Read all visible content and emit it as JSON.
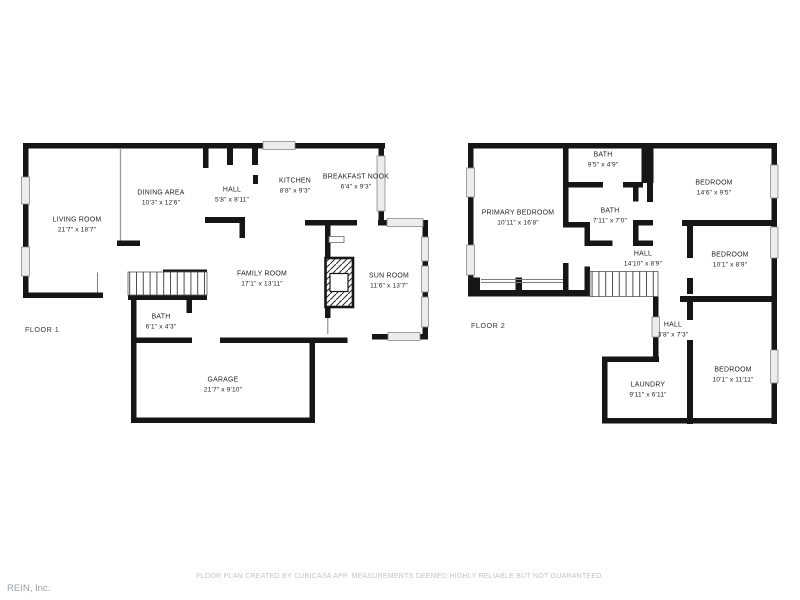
{
  "floors": [
    {
      "label": "FLOOR 1",
      "rooms": [
        {
          "name": "LIVING ROOM",
          "dims": "21'7\" x 18'7\"",
          "x": 77,
          "y": 225
        },
        {
          "name": "DINING AREA",
          "dims": "10'3\" x 12'6\"",
          "x": 161,
          "y": 198
        },
        {
          "name": "HALL",
          "dims": "5'8\" x 8'11\"",
          "x": 232,
          "y": 195
        },
        {
          "name": "KITCHEN",
          "dims": "8'8\" x 9'3\"",
          "x": 295,
          "y": 186
        },
        {
          "name": "BREAKFAST NOOK",
          "dims": "6'4\" x 9'3\"",
          "x": 356,
          "y": 182
        },
        {
          "name": "FAMILY ROOM",
          "dims": "17'1\" x 13'11\"",
          "x": 262,
          "y": 279
        },
        {
          "name": "SUN ROOM",
          "dims": "11'6\" x 13'7\"",
          "x": 389,
          "y": 281
        },
        {
          "name": "BATH",
          "dims": "6'1\" x 4'3\"",
          "x": 161,
          "y": 322
        },
        {
          "name": "GARAGE",
          "dims": "21'7\" x 9'10\"",
          "x": 223,
          "y": 385
        }
      ]
    },
    {
      "label": "FLOOR 2",
      "rooms": [
        {
          "name": "PRIMARY BEDROOM",
          "dims": "10'11\" x 16'8\"",
          "x": 518,
          "y": 218
        },
        {
          "name": "BATH",
          "dims": "9'5\" x 4'9\"",
          "x": 603,
          "y": 160
        },
        {
          "name": "BEDROOM",
          "dims": "14'6\" x 9'5\"",
          "x": 714,
          "y": 188
        },
        {
          "name": "BATH",
          "dims": "7'11\" x 7'0\"",
          "x": 610,
          "y": 216
        },
        {
          "name": "HALL",
          "dims": "14'10\" x 8'9\"",
          "x": 643,
          "y": 259
        },
        {
          "name": "BEDROOM",
          "dims": "10'1\" x 8'9\"",
          "x": 730,
          "y": 260
        },
        {
          "name": "HALL",
          "dims": "3'8\" x 7'3\"",
          "x": 673,
          "y": 330
        },
        {
          "name": "LAUNDRY",
          "dims": "9'11\" x 6'11\"",
          "x": 648,
          "y": 390
        },
        {
          "name": "BEDROOM",
          "dims": "10'1\" x 11'11\"",
          "x": 733,
          "y": 375
        }
      ]
    }
  ],
  "footer": {
    "disclaimer": "FLOOR PLAN CREATED BY CUBICASA APP. MEASUREMENTS DEEMED HIGHLY RELIABLE BUT NOT GUARANTEED."
  },
  "branding": {
    "logo_text": "REIN, Inc."
  },
  "colors": {
    "wall": "#161616",
    "label_text": "#1f1f1f",
    "footer_text": "#c4c4c4",
    "logo_text": "#98a1a6",
    "window_fill": "#ececec"
  }
}
